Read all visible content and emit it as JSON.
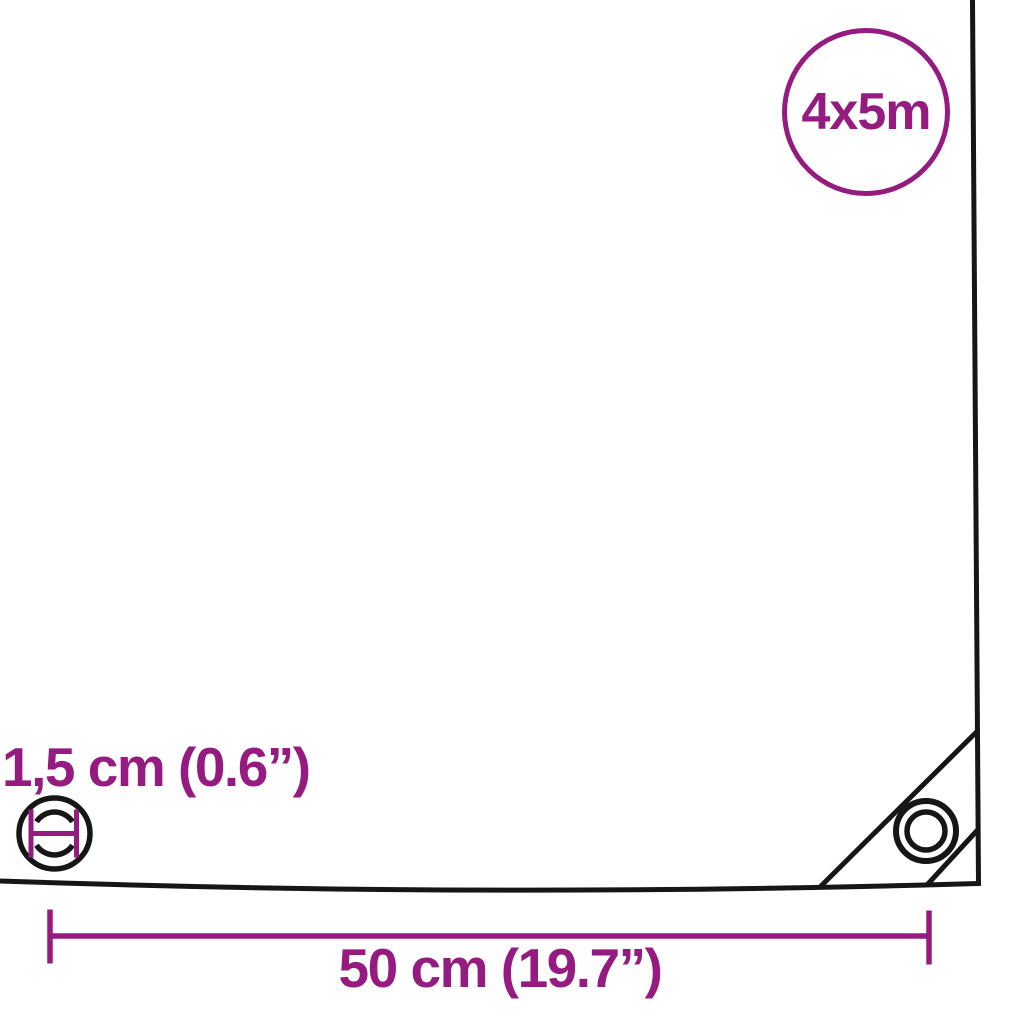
{
  "colors": {
    "accent": "#951b81",
    "line": "#161616",
    "background": "#ffffff"
  },
  "size_badge": {
    "label": "4x5m"
  },
  "labels": {
    "grommet_diameter": "1,5 cm (0.6”)",
    "grommet_spacing": "50 cm (19.7”)"
  }
}
